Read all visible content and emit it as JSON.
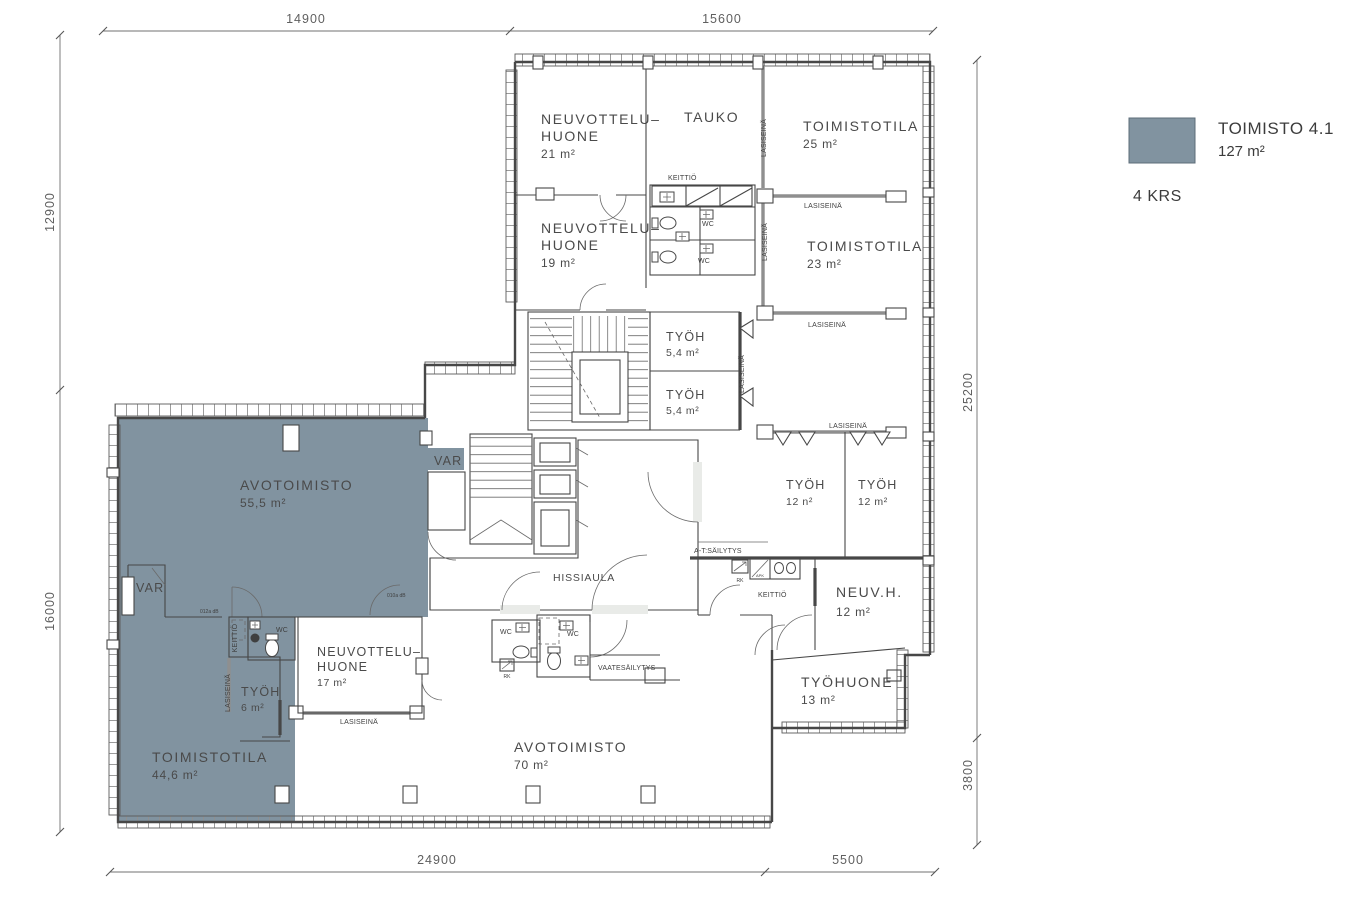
{
  "legend": {
    "title": "TOIMISTO 4.1",
    "area": "127 m²",
    "floor": "4 KRS"
  },
  "colors": {
    "highlight": "#8193a0",
    "lobby": "#e9ebe8"
  },
  "dimensions": {
    "top_left": "14900",
    "top_right": "15600",
    "left_upper": "12900",
    "left_lower": "16000",
    "right_upper": "25200",
    "right_lower": "3800",
    "bottom_left": "24900",
    "bottom_right": "5500"
  },
  "rooms": {
    "neuvottelu_21": {
      "l1": "NEUVOTTELU–",
      "l2": "HUONE",
      "area": "21 m²"
    },
    "tauko": {
      "name": "TAUKO"
    },
    "toimistotila_25": {
      "name": "TOIMISTOTILA",
      "area": "25 m²"
    },
    "toimistotila_23": {
      "name": "TOIMISTOTILA",
      "area": "23 m²"
    },
    "neuvottelu_19": {
      "l1": "NEUVOTTELU–",
      "l2": "HUONE",
      "area": "19 m²"
    },
    "tyoh_54_a": {
      "name": "TYÖH",
      "area": "5,4 m²"
    },
    "tyoh_54_b": {
      "name": "TYÖH",
      "area": "5,4 m²"
    },
    "avotoimisto_55": {
      "name": "AVOTOIMISTO",
      "area": "55,5 m²"
    },
    "var_right": {
      "name": "VAR"
    },
    "var_left": {
      "name": "VAR"
    },
    "hissiaula": {
      "name": "HISSIAULA"
    },
    "tyoh_12_a": {
      "name": "TYÖH",
      "area": "12 n²"
    },
    "tyoh_12_b": {
      "name": "TYÖH",
      "area": "12 m²"
    },
    "neuv_h_12": {
      "name": "NEUV.H.",
      "area": "12 m²"
    },
    "tyohuone_13": {
      "name": "TYÖHUONE",
      "area": "13 m²"
    },
    "toimistotila_44": {
      "name": "TOIMISTOTILA",
      "area": "44,6 m²"
    },
    "tyoh_6": {
      "name": "TYÖH",
      "area": "6 m²"
    },
    "neuvottelu_17": {
      "l1": "NEUVOTTELU–",
      "l2": "HUONE",
      "area": "17 m²"
    },
    "avotoimisto_70": {
      "name": "AVOTOIMISTO",
      "area": "70 m²"
    }
  },
  "labels": {
    "lasiseina": "LASISEINÄ",
    "keittio": "KEITTIÖ",
    "wc": "WC",
    "at_sailytys": "A-T:SÄILYTYS",
    "vaatesailytys": "VAATESÄILYTYS",
    "rk": "RK",
    "apk": "APK",
    "door_a": "012a dB",
    "door_b": "010a dB"
  }
}
